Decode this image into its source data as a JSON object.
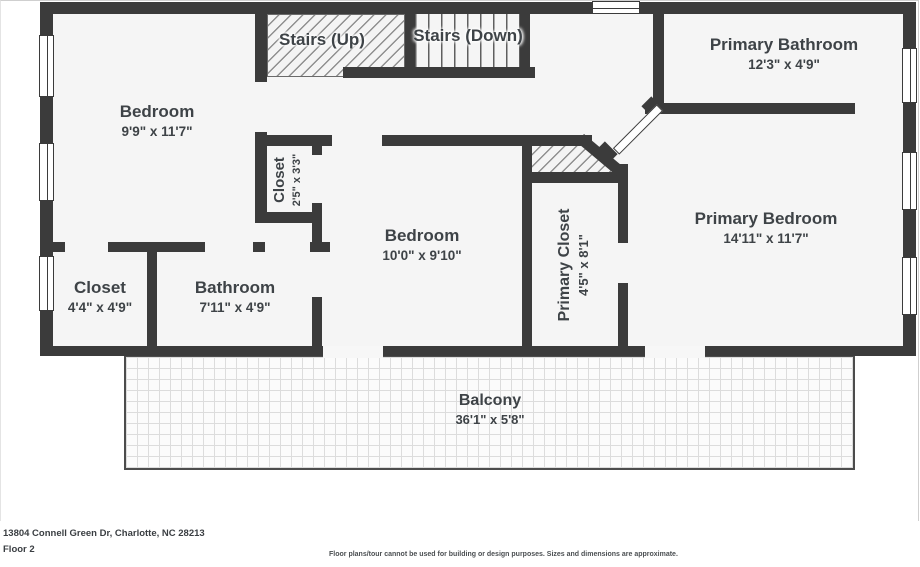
{
  "colors": {
    "wall": "#3b3b3b",
    "room_fill": "#f5f5f5",
    "label_text": "#3e4347"
  },
  "rooms": {
    "bedroom1": {
      "name": "Bedroom",
      "dims": "9'9\" x 11'7\""
    },
    "stairs_up": {
      "name": "Stairs (Up)"
    },
    "stairs_down": {
      "name": "Stairs (Down)"
    },
    "primary_bathroom": {
      "name": "Primary Bathroom",
      "dims": "12'3\" x 4'9\""
    },
    "closet_small": {
      "name": "Closet",
      "dims": "2'5\" x 3'3\""
    },
    "bedroom2": {
      "name": "Bedroom",
      "dims": "10'0\" x 9'10\""
    },
    "primary_closet": {
      "name": "Primary Closet",
      "dims": "4'5\" x 8'1\""
    },
    "primary_bedroom": {
      "name": "Primary Bedroom",
      "dims": "14'11\" x 11'7\""
    },
    "closet2": {
      "name": "Closet",
      "dims": "4'4\" x 4'9\""
    },
    "bathroom": {
      "name": "Bathroom",
      "dims": "7'11\" x 4'9\""
    },
    "balcony": {
      "name": "Balcony",
      "dims": "36'1\" x 5'8\""
    }
  },
  "footer": {
    "address": "13804 Connell Green Dr, Charlotte, NC 28213",
    "floor_label": "Floor 2",
    "disclaimer": "Floor plans/tour cannot be used for building or design purposes. Sizes and dimensions are approximate."
  }
}
